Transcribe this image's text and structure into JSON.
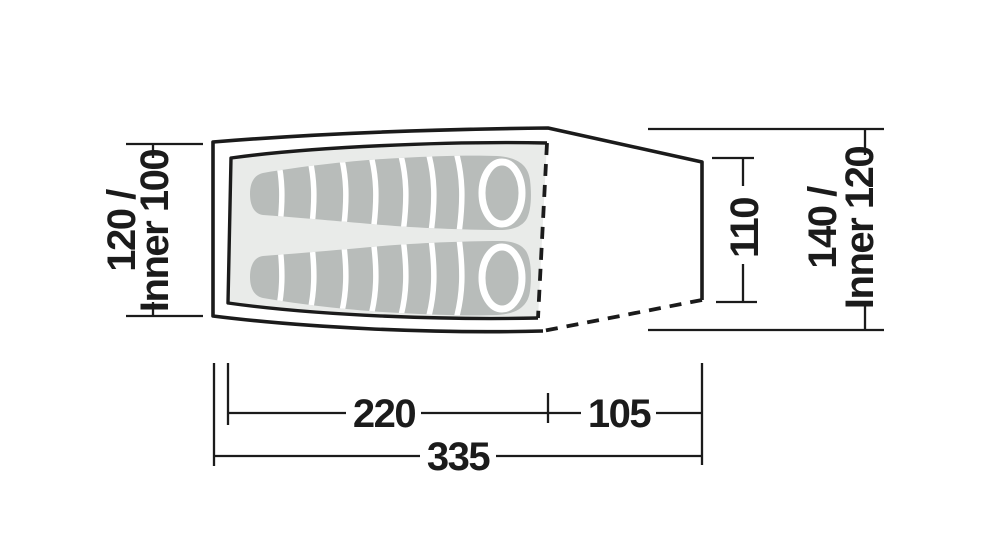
{
  "diagram": {
    "kind": "tent-floorplan-with-dimensions",
    "dimension_labels": {
      "front_width": {
        "line1": "120 /",
        "line2": "Inner 100"
      },
      "rear_inner_width": "110",
      "rear_width": {
        "line1": "140 /",
        "line2": "Inner 120"
      },
      "inner_length": "220",
      "porch_length": "105",
      "total_length": "335"
    },
    "colors": {
      "line": "#1b1b1b",
      "inner_floor_fill": "#e9ebe9",
      "sleeping_bag_fill": "#b8bcba",
      "background": "#ffffff"
    }
  }
}
